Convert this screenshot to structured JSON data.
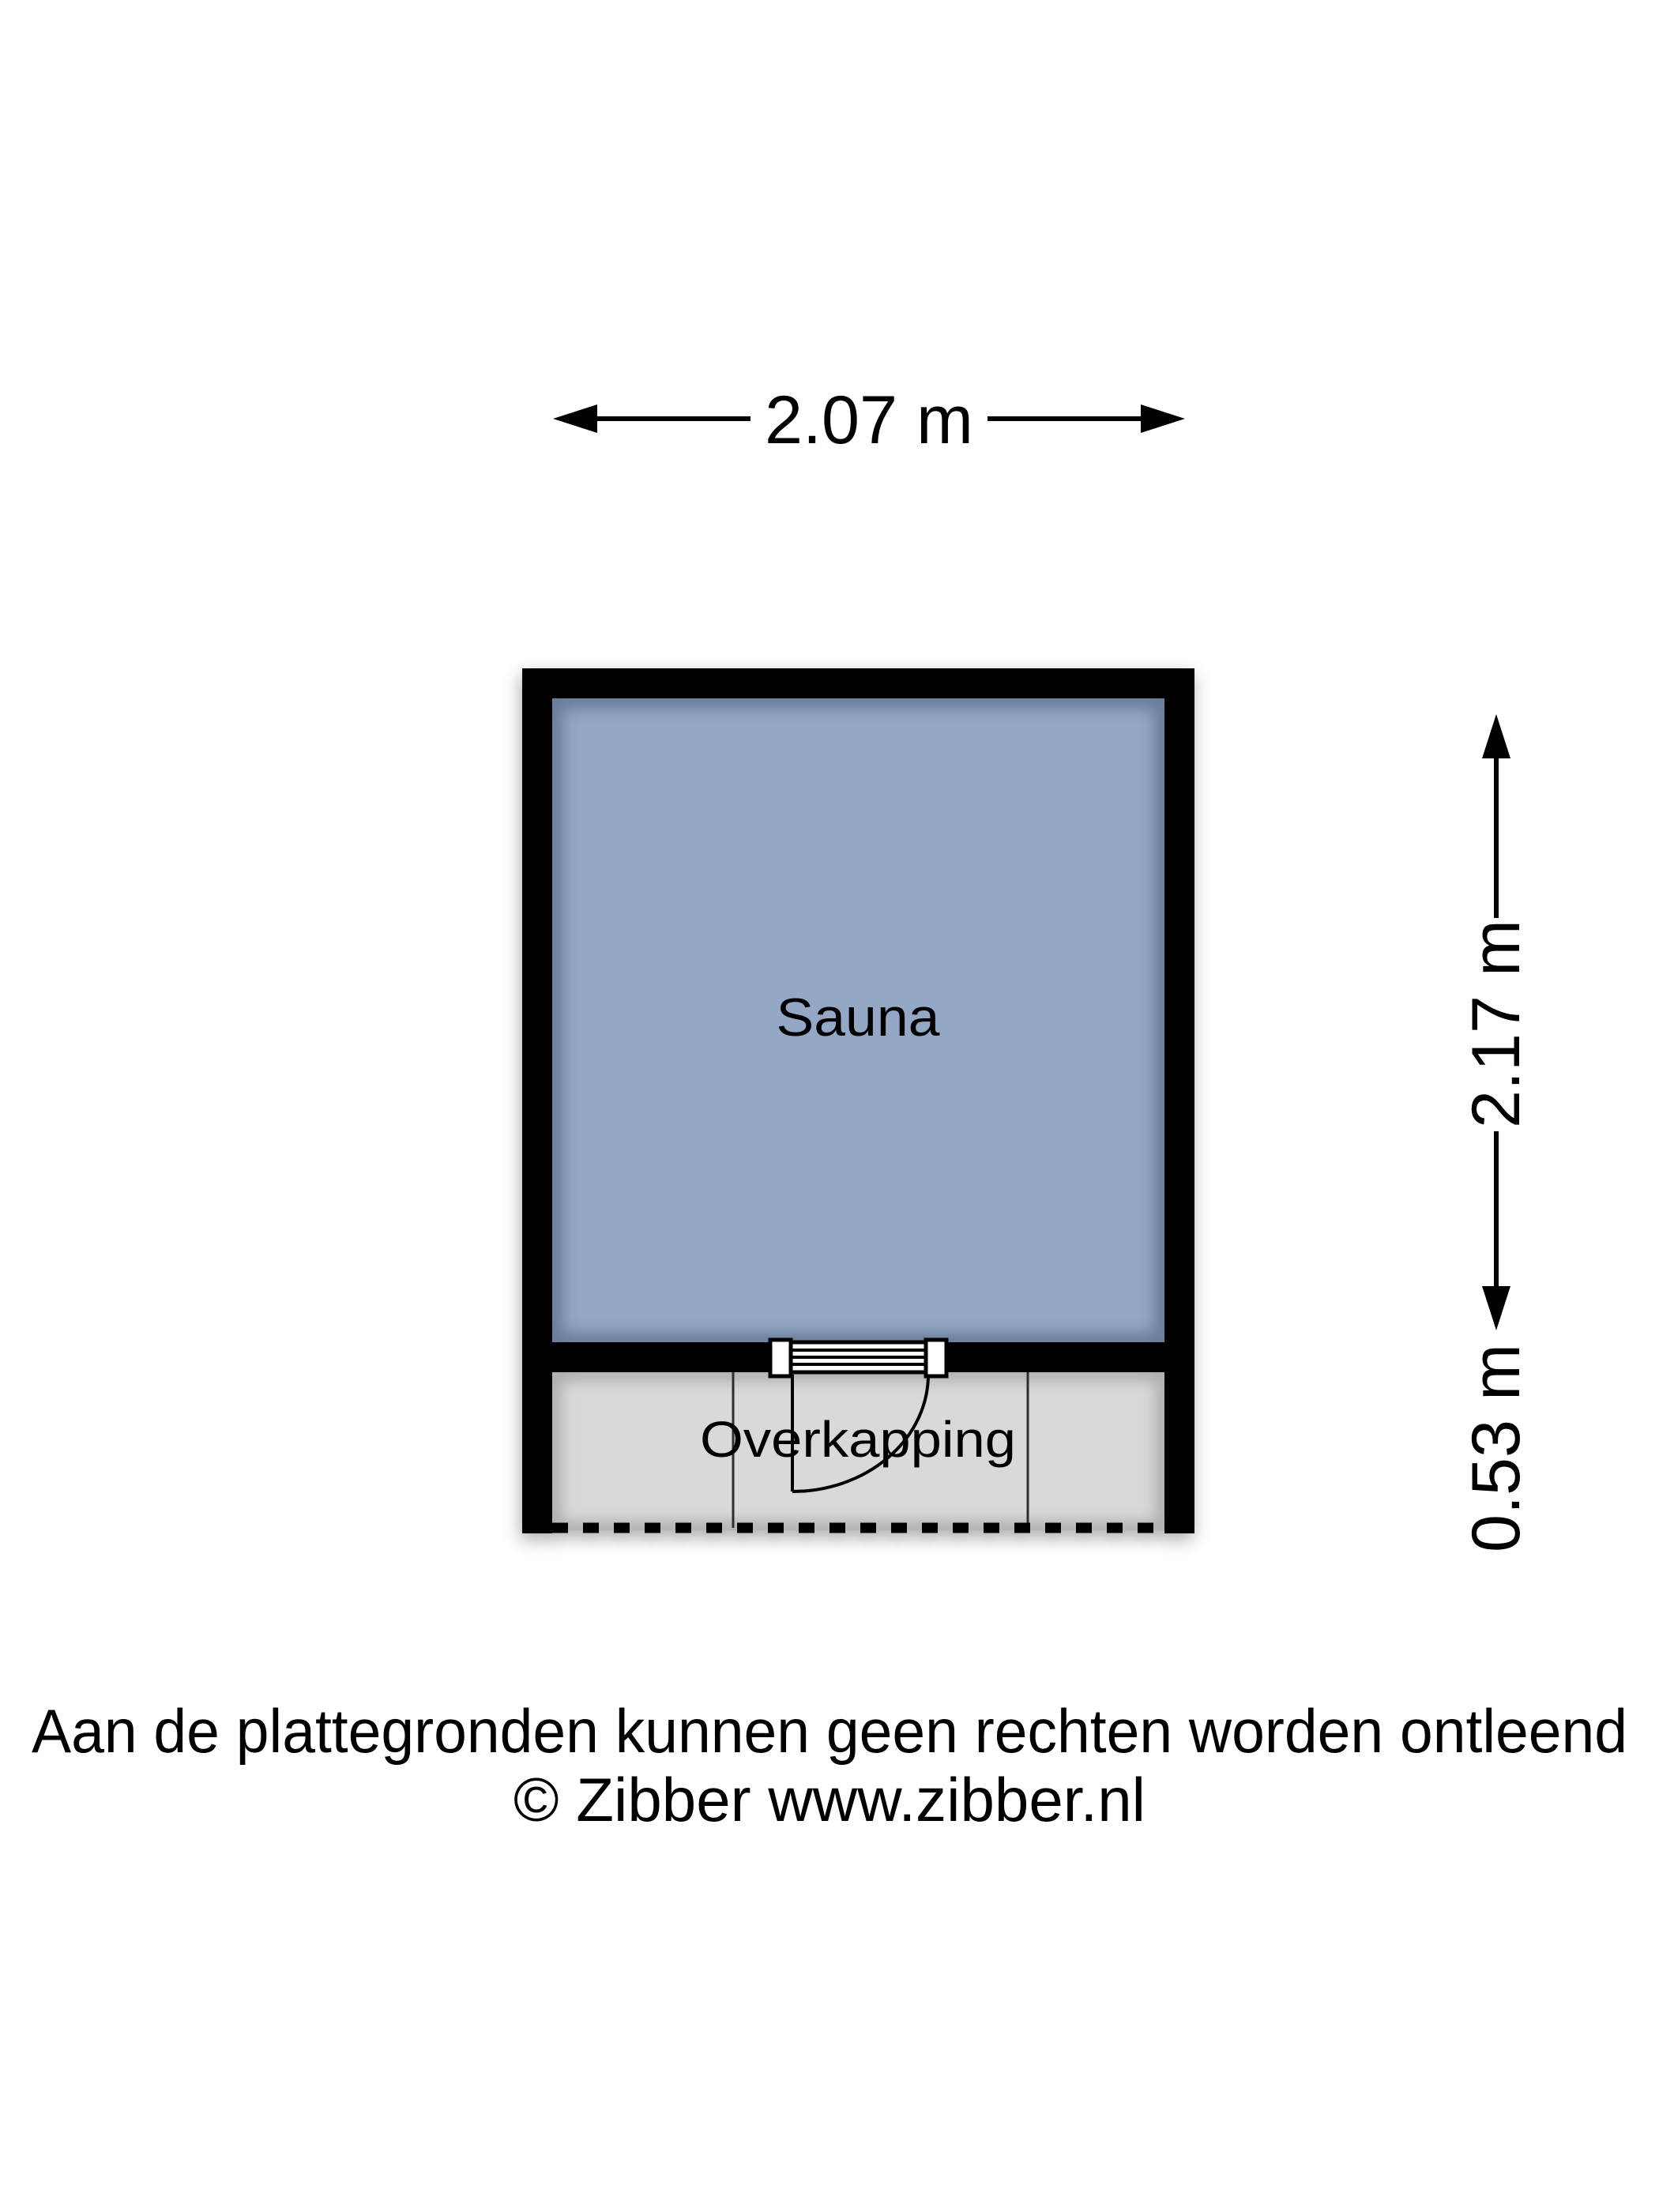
{
  "plan": {
    "room": {
      "label": "Sauna"
    },
    "canopy": {
      "label": "Overkapping"
    },
    "dimensions": {
      "width": "2.07 m",
      "height_upper": "2.17 m",
      "height_lower": "0.53 m"
    }
  },
  "footer": {
    "disclaimer": "Aan de plattegronden kunnen geen rechten worden ontleend",
    "copyright": "© Zibber www.zibber.nl"
  },
  "colors": {
    "wall": "#000000",
    "room_fill": "#94a7c4",
    "canopy_fill": "#d9d9d9",
    "line": "#000000"
  }
}
